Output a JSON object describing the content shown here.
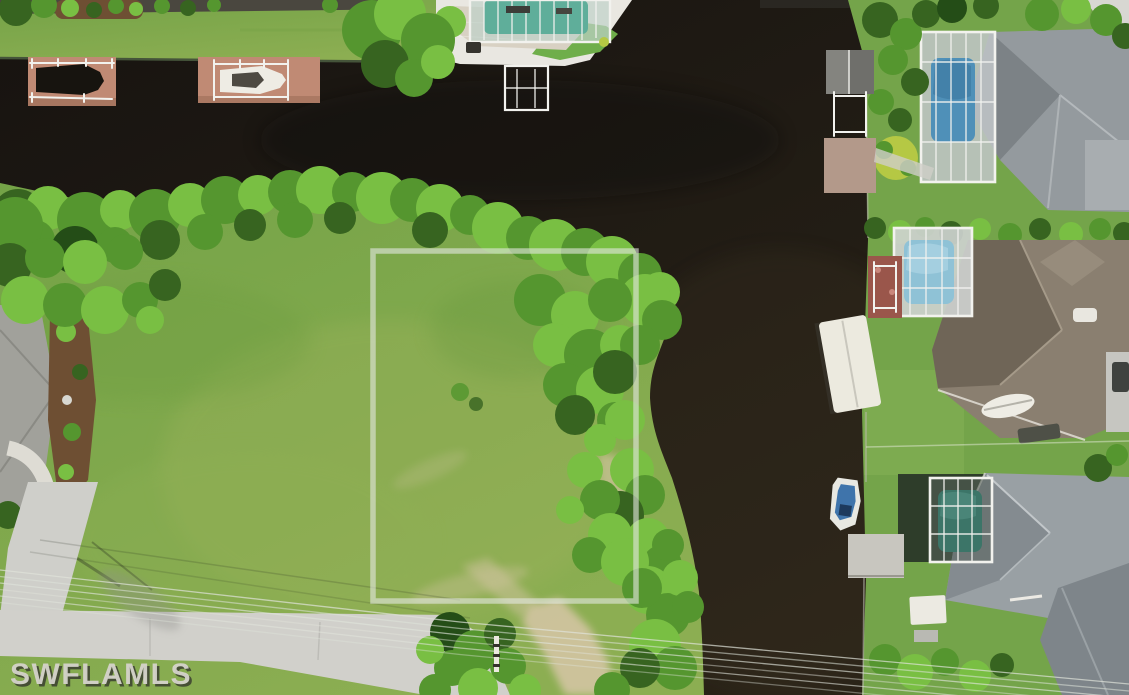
{
  "meta": {
    "description": "Aerial drone photo of a waterfront vacant lot on a canal with highlighted parcel boundary",
    "canvas_width": 1129,
    "canvas_height": 695
  },
  "watermark": {
    "text": "SWFLAMLS",
    "x": 10,
    "y": 684,
    "font_size": 30
  },
  "lot_boundary": {
    "x": 373,
    "y": 251,
    "width": 263,
    "height": 350,
    "stroke_width": 5.5,
    "color": "rgba(228,232,226,0.6)"
  },
  "palette": {
    "water": "#1d1812",
    "water_warm": "#2e2619",
    "lawn": "#7aa84b",
    "lawn_light": "#8cae52",
    "lot_grass": "#9db25c",
    "tree_bright": "#79bf43",
    "tree_mid": "#55962f",
    "tree_dark": "#376420",
    "tree_deep": "#244d17",
    "palm_yellow": "#b5c844",
    "road": "#d1d0cb",
    "concrete": "#e9e7e1",
    "paver": "#d8d1c3",
    "dock_pink": "#c08a74",
    "mulch": "#6e4f33",
    "sand": "#d3c5a2",
    "roof_gray": "#949a9e",
    "roof_gray_dark": "#7c8286",
    "roof_brown": "#8a7f70",
    "roof_brown_dark": "#6f6557",
    "roof_slate": "#99a0a4",
    "roof_slate_dark": "#848b90",
    "roof_left": "#a1a19b",
    "pool_teal": "#5fae9a",
    "pool_blue": "#4f90b8",
    "pool_sky": "#8fc2d6",
    "pool_green": "#3c7568",
    "screen_frame": "#f2f2ee",
    "boat_white": "#eeece4",
    "boat_dark": "#17140f",
    "boat_blue": "#3f74ab",
    "wire": "#dfe3da",
    "watermark_fill": "#d5d3cb",
    "watermark_shadow": "#30302b"
  }
}
